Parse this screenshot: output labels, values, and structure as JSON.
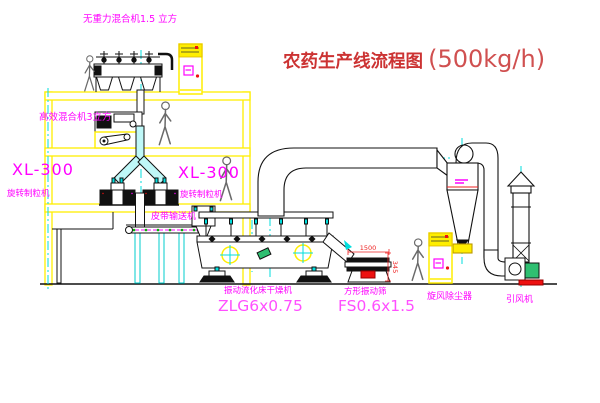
{
  "title": {
    "name": "农药生产线流程图",
    "capacity": "(500kg/h)"
  },
  "labels": {
    "gravity_mixer": "无重力混合机1.5 立方",
    "high_efficiency_mixer": "高效混合机3立方",
    "granulator_left_model": "XL-300",
    "granulator_left_name": "旋转制粒机",
    "granulator_right_model": "XL-300",
    "granulator_right_name": "旋转制粒机",
    "belt_conveyor": "皮带输送机",
    "fluid_bed_dryer": "振动流化床干燥机",
    "fluid_bed_dryer_model": "ZLG6x0.75",
    "square_vibrating_sieve": "方形振动筛",
    "square_vibrating_sieve_model": "FS0.6x1.5",
    "cyclone_dust_collector": "旋风除尘器",
    "induced_draft_fan": "引风机"
  },
  "dimensions": {
    "sieve_length": "1500",
    "sieve_outlet_height": "345"
  },
  "colors": {
    "structure_yellow": "#ffee00",
    "centerline_cyan": "#00dede",
    "label_magenta": "#ff00ff",
    "model_pink": "#ff4fff",
    "title_red": "#cc3333",
    "dimension_red": "#ee2222",
    "motor_green": "#2fbf71",
    "base_red": "#ee1111",
    "duct_cyan_fill": "#bff8f8"
  }
}
